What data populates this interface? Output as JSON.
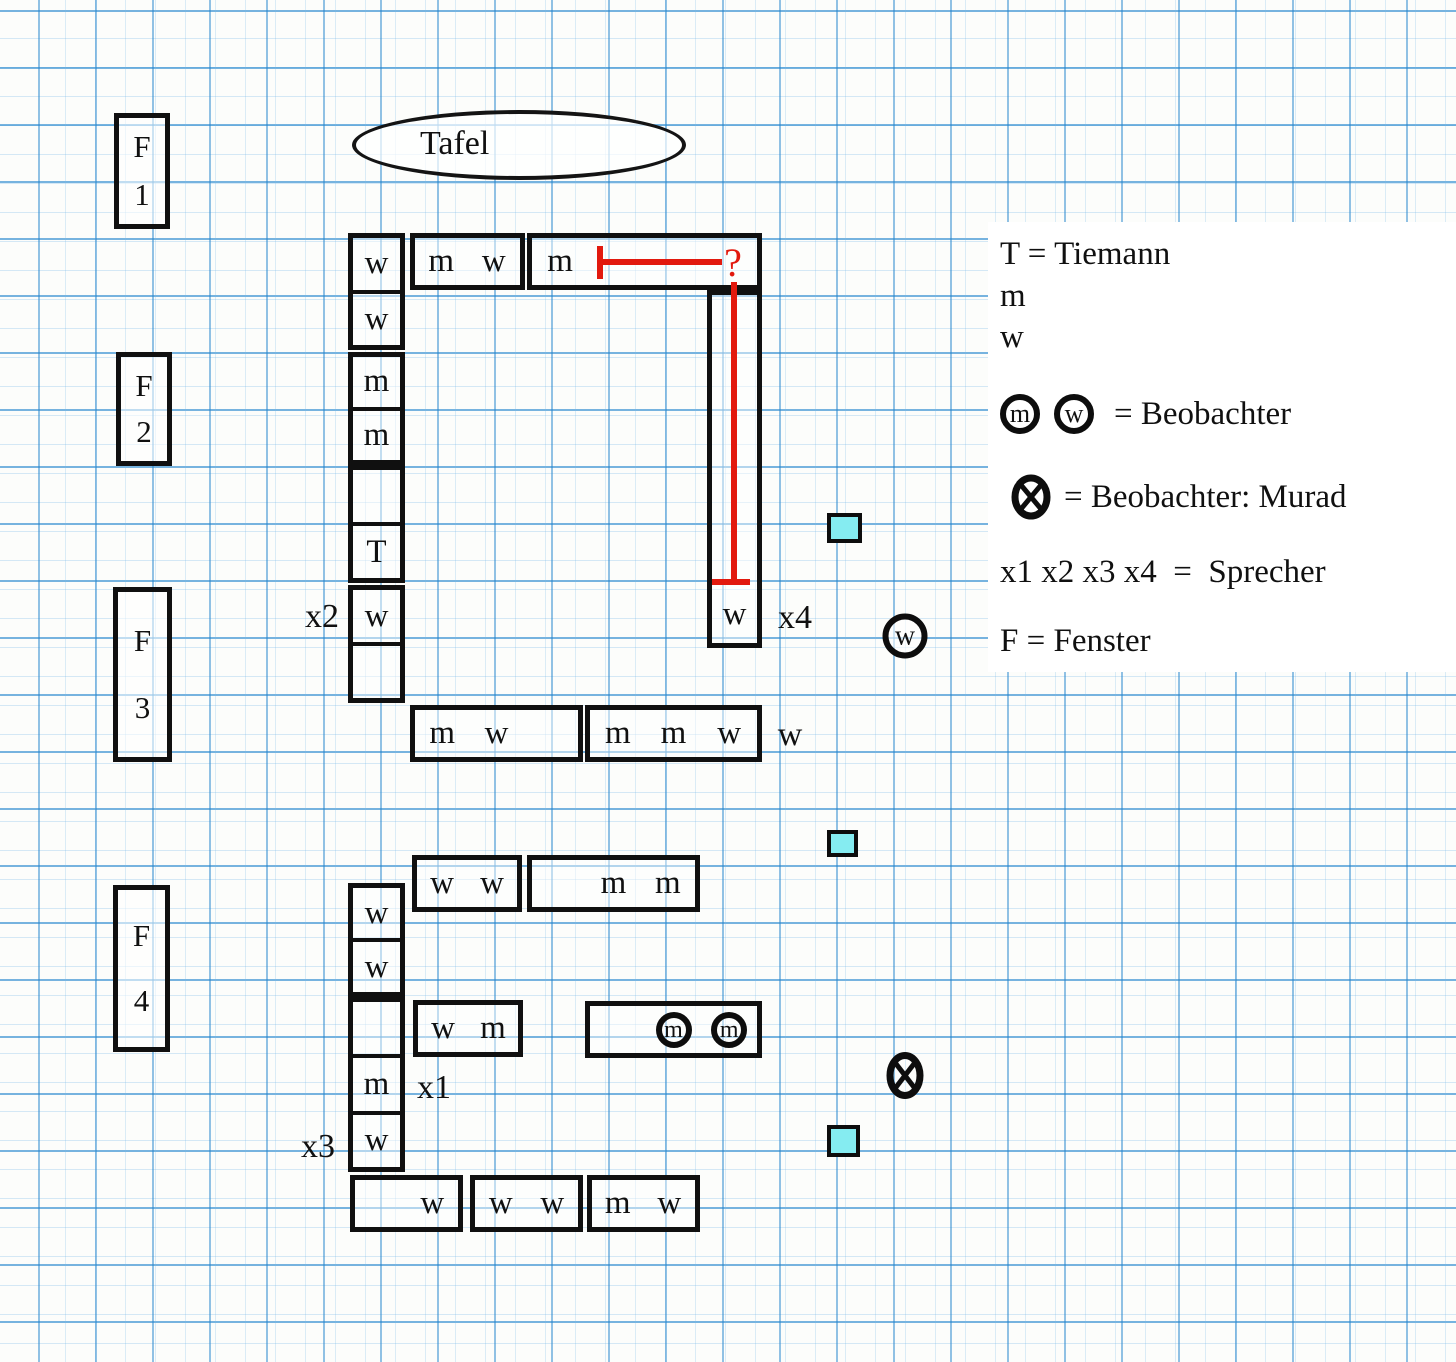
{
  "colors": {
    "red": "#e2190e",
    "cyan": "#85ecf1",
    "ink": "#101010",
    "grid_blue": "#2486ce"
  },
  "board": {
    "label": "Tafel"
  },
  "windows": [
    {
      "top": "F",
      "bottom": "1",
      "x": 114,
      "y": 113,
      "w": 56,
      "h": 116
    },
    {
      "top": "F",
      "bottom": "2",
      "x": 116,
      "y": 352,
      "w": 56,
      "h": 114
    },
    {
      "top": "F",
      "bottom": "3",
      "x": 113,
      "y": 587,
      "w": 59,
      "h": 175
    },
    {
      "top": "F",
      "bottom": "4",
      "x": 113,
      "y": 885,
      "w": 57,
      "h": 167
    }
  ],
  "desks": [
    {
      "x": 348,
      "y": 233,
      "w": 57,
      "h": 117,
      "o": "v",
      "div": true,
      "cells": [
        "w",
        "w"
      ]
    },
    {
      "x": 348,
      "y": 352,
      "w": 57,
      "h": 113,
      "o": "v",
      "div": true,
      "cells": [
        "m",
        "m"
      ]
    },
    {
      "x": 348,
      "y": 465,
      "w": 57,
      "h": 118,
      "o": "v",
      "div": true,
      "cells": [
        "",
        "T"
      ]
    },
    {
      "x": 348,
      "y": 585,
      "w": 57,
      "h": 118,
      "o": "v",
      "div": true,
      "cells": [
        "w",
        ""
      ]
    },
    {
      "x": 410,
      "y": 233,
      "w": 115,
      "h": 57,
      "o": "h",
      "div": false,
      "cells": [
        "m",
        "w"
      ]
    },
    {
      "x": 527,
      "y": 233,
      "w": 235,
      "h": 57,
      "o": "h",
      "div": false,
      "cells": [
        "m",
        "",
        "",
        ""
      ]
    },
    {
      "x": 707,
      "y": 290,
      "w": 55,
      "h": 358,
      "o": "v",
      "div": false,
      "cells": [
        "",
        "",
        "",
        "",
        "",
        "w"
      ]
    },
    {
      "x": 410,
      "y": 705,
      "w": 173,
      "h": 57,
      "o": "h",
      "div": false,
      "cells": [
        "m",
        "w",
        ""
      ]
    },
    {
      "x": 585,
      "y": 705,
      "w": 177,
      "h": 57,
      "o": "h",
      "div": false,
      "cells": [
        "m",
        "m",
        "w"
      ]
    },
    {
      "x": 348,
      "y": 883,
      "w": 57,
      "h": 114,
      "o": "v",
      "div": true,
      "cells": [
        "w",
        "w"
      ]
    },
    {
      "x": 348,
      "y": 997,
      "w": 57,
      "h": 175,
      "o": "v",
      "div": true,
      "cells": [
        "",
        "m",
        "w"
      ]
    },
    {
      "x": 412,
      "y": 855,
      "w": 110,
      "h": 57,
      "o": "h",
      "div": false,
      "cells": [
        "w",
        "w"
      ]
    },
    {
      "x": 527,
      "y": 855,
      "w": 173,
      "h": 57,
      "o": "h",
      "div": false,
      "cells": [
        "",
        "m",
        "m"
      ]
    },
    {
      "x": 413,
      "y": 1000,
      "w": 110,
      "h": 57,
      "o": "h",
      "div": false,
      "cells": [
        "w",
        "m"
      ]
    },
    {
      "x": 585,
      "y": 1001,
      "w": 177,
      "h": 57,
      "o": "h",
      "div": false,
      "cells": [
        "",
        {
          "t": "m",
          "c": true
        },
        {
          "t": "m",
          "c": true
        }
      ]
    },
    {
      "x": 350,
      "y": 1175,
      "w": 113,
      "h": 57,
      "o": "h",
      "div": false,
      "cells": [
        "",
        "w"
      ]
    },
    {
      "x": 470,
      "y": 1175,
      "w": 113,
      "h": 57,
      "o": "h",
      "div": false,
      "cells": [
        "w",
        "w"
      ]
    },
    {
      "x": 587,
      "y": 1175,
      "w": 113,
      "h": 57,
      "o": "h",
      "div": false,
      "cells": [
        "m",
        "w"
      ]
    }
  ],
  "floating_labels": [
    {
      "text": "x2",
      "x": 322,
      "y": 617
    },
    {
      "text": "x4",
      "x": 795,
      "y": 618
    },
    {
      "text": "w",
      "x": 790,
      "y": 735
    },
    {
      "text": "x1",
      "x": 434,
      "y": 1088
    },
    {
      "text": "x3",
      "x": 318,
      "y": 1147
    }
  ],
  "markers": {
    "cyan_squares": [
      {
        "x": 827,
        "y": 513,
        "w": 35,
        "h": 30
      },
      {
        "x": 827,
        "y": 830,
        "w": 31,
        "h": 27
      },
      {
        "x": 827,
        "y": 1125,
        "w": 33,
        "h": 32
      }
    ],
    "circled_letters": [
      {
        "letter": "w",
        "x": 905,
        "y": 636
      }
    ],
    "circled_x_markers": [
      {
        "x": 905,
        "y": 1078
      }
    ]
  },
  "red_annotation": {
    "question_mark": "?"
  },
  "legend": {
    "tiemann": "T = Tiemann",
    "m": "m",
    "w": "w",
    "circ_m": "m",
    "circ_w": "w",
    "beobachter": "= Beobachter",
    "murad": "= Beobachter: Murad",
    "sprecher": "x1 x2 x3 x4  =  Sprecher",
    "fenster": "F = Fenster"
  }
}
